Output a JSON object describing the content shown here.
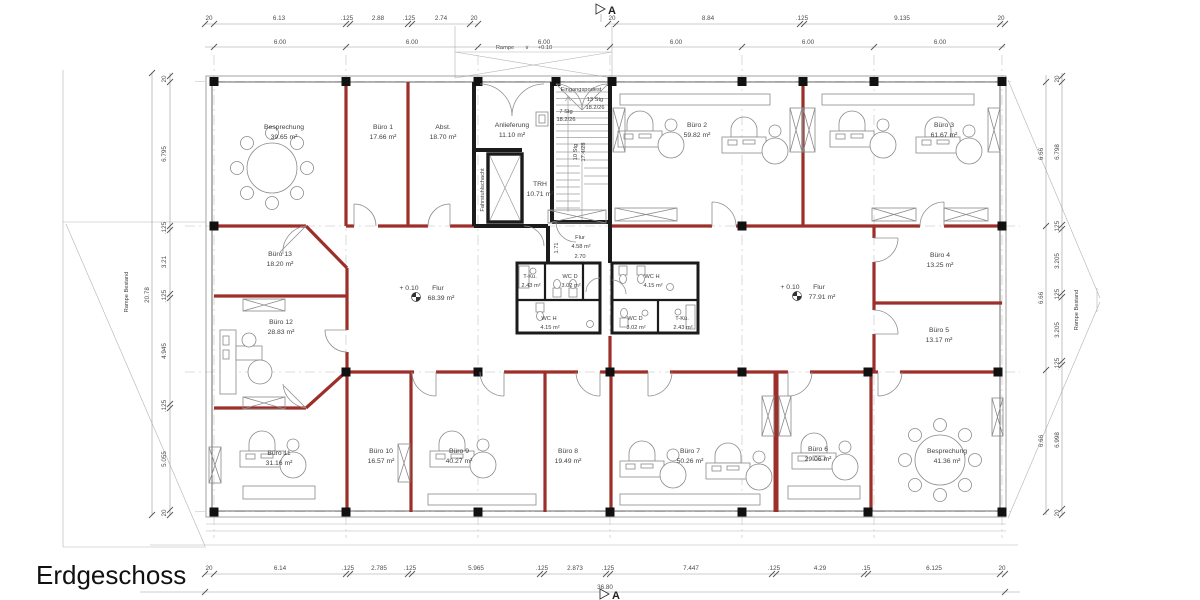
{
  "title": "Erdgeschoss",
  "markers": {
    "section_top": "A",
    "section_bottom": "A"
  },
  "exterior": {
    "rampe_left": "Rampe Bestand",
    "rampe_right": "Rampe Bestand",
    "rampe_top": "Rampe",
    "rampe_top_sym": "∨",
    "rampe_top_level": "+0.10"
  },
  "core": {
    "eingangspodest": "Eingangspodest",
    "stg13": "13 Stg",
    "stg13_ratio": "18.2/26",
    "stg7": "7 Stg",
    "stg7_ratio": "18.2/26",
    "stg10": "10 Stg",
    "stg10_ratio": "17.4/28",
    "fahrstuhl": "Fahrstuhlschacht",
    "trh": {
      "name": "TRH",
      "area": "10.71 m²"
    }
  },
  "corridors": {
    "flur_left": {
      "level": "+ 0.10",
      "name": "Flur",
      "area": "68.39 m²"
    },
    "flur_right": {
      "level": "+ 0.10",
      "name": "Flur",
      "area": "77.91 m²"
    },
    "flur_small": {
      "name": "Flur",
      "area": "4.58 m²",
      "width": "2.70",
      "depth": "1.71"
    }
  },
  "rooms": {
    "besprechung_top": {
      "name": "Besprechung",
      "area": "39.65 m²"
    },
    "buero1": {
      "name": "Büro 1",
      "area": "17.66 m²"
    },
    "abstellraum": {
      "name": "Abst.",
      "area": "18.70 m²"
    },
    "anlieferung": {
      "name": "Anlieferung",
      "area": "11.10 m²"
    },
    "buero2": {
      "name": "Büro 2",
      "area": "59.82 m²"
    },
    "buero3": {
      "name": "Büro 3",
      "area": "61.67 m²"
    },
    "buero13": {
      "name": "Büro 13",
      "area": "18.20 m²"
    },
    "buero12": {
      "name": "Büro 12",
      "area": "28.83 m²"
    },
    "buero4": {
      "name": "Büro 4",
      "area": "13.25 m²"
    },
    "buero5": {
      "name": "Büro 5",
      "area": "13.17 m²"
    },
    "tkue_left": {
      "name": "T-Kü.",
      "area": "2.43 m²"
    },
    "wcd_left": {
      "name": "WC D",
      "area": "3.02 m²"
    },
    "wch_left": {
      "name": "WC H",
      "area": "4.15 m²"
    },
    "wch_right": {
      "name": "WC H",
      "area": "4.15 m²"
    },
    "wcd_right": {
      "name": "WC D",
      "area": "3.02 m²"
    },
    "tkue_right": {
      "name": "T-Kü.",
      "area": "2.43 m²"
    },
    "buero11": {
      "name": "Büro 11",
      "area": "31.16 m²"
    },
    "buero10": {
      "name": "Büro 10",
      "area": "16.57 m²"
    },
    "buero9": {
      "name": "Büro 9",
      "area": "40.27 m²"
    },
    "buero8": {
      "name": "Büro 8",
      "area": "19.49 m²"
    },
    "buero7": {
      "name": "Büro 7",
      "area": "50.26 m²"
    },
    "buero6": {
      "name": "Büro 6",
      "area": "29.06 m²"
    },
    "besprechung_bottom": {
      "name": "Besprechung",
      "area": "41.36 m²"
    }
  },
  "dims": {
    "top_outer": [
      "20",
      "6.13",
      ".125",
      "2.88",
      ".125",
      "2.74",
      "20",
      "20",
      "8.84",
      ".125",
      "9.135",
      "20"
    ],
    "top_grid": [
      "6.00",
      "6.00",
      "6.00",
      "6.00",
      "6.00",
      "6.00"
    ],
    "bottom_outer": [
      "20",
      "6.14",
      ".125",
      "2.785",
      ".125",
      "5.965",
      ".125",
      "2.873",
      ".125",
      "7.447",
      ".125",
      "4.29",
      ".15",
      "6.125",
      "20"
    ],
    "bottom_total": "36.80",
    "left_total": "20.78",
    "left_outer": [
      "20",
      "6.795",
      ".125",
      "3.21",
      ".125",
      "4.945",
      ".125",
      "5.055",
      "20"
    ],
    "right_grid": [
      "6.66",
      "6.66",
      "6.66"
    ],
    "right_outer": [
      "20",
      "6.798",
      ".125",
      "3.205",
      ".125",
      "3.205",
      ".125",
      "6.998",
      "20"
    ]
  },
  "colors": {
    "wall_new_red": "#9d2f2a",
    "wall_existing_black": "#1b1b1b",
    "dim_text": "#4a4a4a",
    "label_text": "#3f3f3f",
    "line_gray": "#9a9a9a"
  }
}
